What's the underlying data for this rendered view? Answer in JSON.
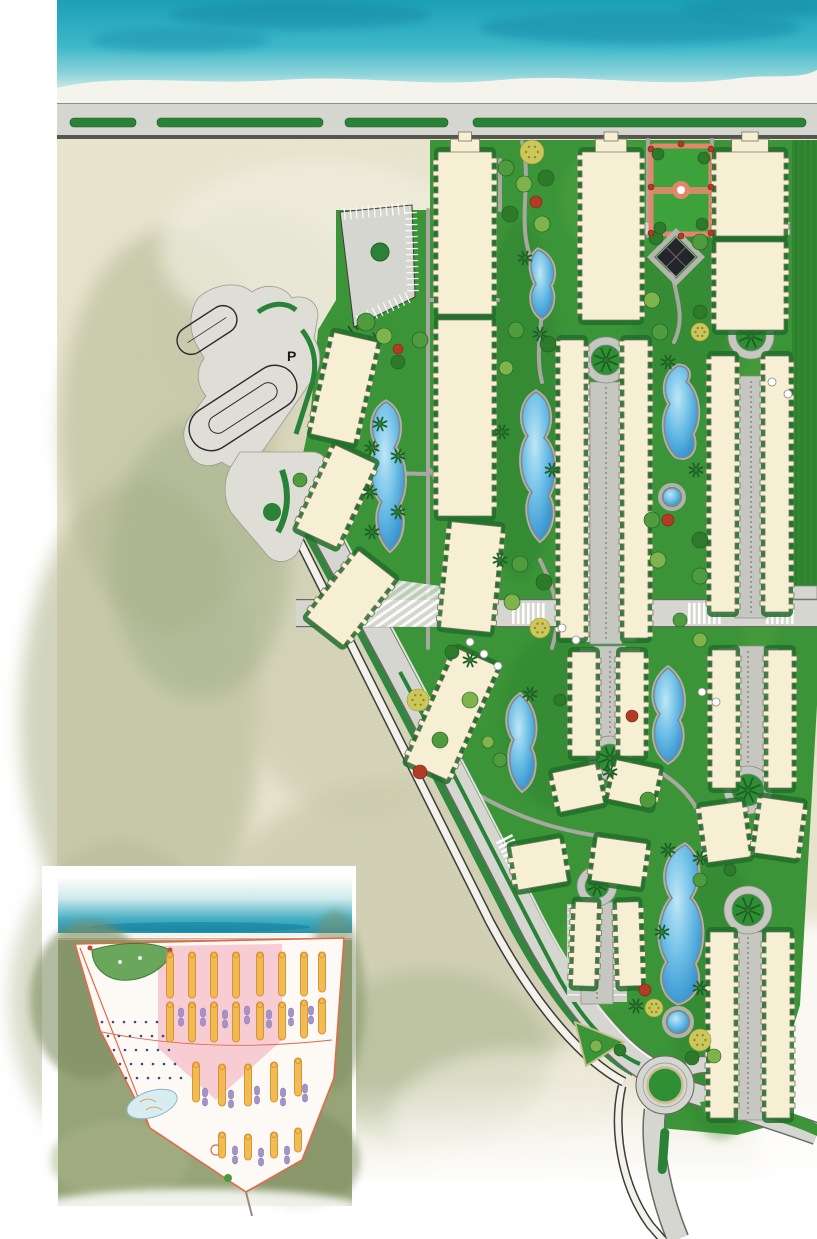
{
  "title": "beachfront-resort-master-plan",
  "labels": {
    "parking_upper": "P",
    "parking_lower": "P"
  },
  "palette": {
    "sea1": "#1d9fb8",
    "sea2": "#3db8c9",
    "sea3": "#8fd4da",
    "foam": "#f5f4ec",
    "road": "#d6d6d0",
    "roadedge": "#55554f",
    "median": "#2a8238",
    "sand1": "#e7e3cd",
    "sand2": "#c9c9ab",
    "sandolive": "#b3b893",
    "site": "#3c9438",
    "sitedark": "#2a7d2e",
    "hedge": "#206f2a",
    "lawnlight": "#52a63e",
    "bld": "#f6efd4",
    "bldedge": "#76765f",
    "path": "#a8a8a0",
    "spine": "#c7c7c1",
    "pool1": "#bfe6f5",
    "pool2": "#2285c8",
    "poolrim": "#7e8a90",
    "treedark": "#2e7a2b",
    "treemid": "#4f9c3e",
    "treelight": "#7fb44c",
    "flower": "#cdc659",
    "red": "#b23b24",
    "palmc": "#1d5f24",
    "pgborder": "#e2876b",
    "pggreen": "#3da23c",
    "diamond": "#24242a",
    "marina": "#dfded6",
    "ink": "#2a2a2a",
    "iland": "#97a478",
    "iline": "#e06a4a",
    "iorange": "#f0b94c",
    "iorangeedge": "#d98f2e",
    "ipurple": "#a493c8",
    "ipink": "#f2a8b4",
    "isea": "#2f9fc0"
  },
  "map": {
    "buildings": [
      {
        "x": 438,
        "y": 152,
        "w": 54,
        "h": 162,
        "cap": 1
      },
      {
        "x": 438,
        "y": 320,
        "w": 54,
        "h": 196
      },
      {
        "x": 582,
        "y": 152,
        "w": 58,
        "h": 168,
        "cap": 1
      },
      {
        "x": 560,
        "y": 340,
        "w": 24,
        "h": 298
      },
      {
        "x": 624,
        "y": 340,
        "w": 24,
        "h": 298
      },
      {
        "x": 716,
        "y": 152,
        "w": 68,
        "h": 84,
        "cap": 1
      },
      {
        "x": 716,
        "y": 242,
        "w": 68,
        "h": 88
      },
      {
        "x": 711,
        "y": 356,
        "w": 24,
        "h": 256
      },
      {
        "x": 765,
        "y": 356,
        "w": 24,
        "h": 256
      },
      {
        "x": 322,
        "y": 336,
        "w": 44,
        "h": 104,
        "r": 13
      },
      {
        "x": 314,
        "y": 450,
        "w": 44,
        "h": 92,
        "r": 25
      },
      {
        "x": 328,
        "y": 556,
        "w": 46,
        "h": 84,
        "r": 38
      },
      {
        "x": 446,
        "y": 524,
        "w": 50,
        "h": 106,
        "r": 6
      },
      {
        "x": 430,
        "y": 652,
        "w": 44,
        "h": 124,
        "r": 24
      },
      {
        "x": 572,
        "y": 652,
        "w": 24,
        "h": 104
      },
      {
        "x": 620,
        "y": 652,
        "w": 24,
        "h": 104
      },
      {
        "x": 556,
        "y": 768,
        "w": 44,
        "h": 40,
        "r": -12
      },
      {
        "x": 612,
        "y": 764,
        "w": 44,
        "h": 40,
        "r": 12
      },
      {
        "x": 712,
        "y": 650,
        "w": 24,
        "h": 138
      },
      {
        "x": 768,
        "y": 650,
        "w": 24,
        "h": 138
      },
      {
        "x": 704,
        "y": 804,
        "w": 42,
        "h": 56,
        "r": -8
      },
      {
        "x": 758,
        "y": 800,
        "w": 42,
        "h": 56,
        "r": 8
      },
      {
        "x": 514,
        "y": 842,
        "w": 50,
        "h": 44,
        "r": -10
      },
      {
        "x": 594,
        "y": 840,
        "w": 50,
        "h": 44,
        "r": 8
      },
      {
        "x": 574,
        "y": 902,
        "w": 22,
        "h": 84,
        "r": 2
      },
      {
        "x": 618,
        "y": 902,
        "w": 22,
        "h": 84,
        "r": -2
      },
      {
        "x": 710,
        "y": 932,
        "w": 24,
        "h": 186
      },
      {
        "x": 766,
        "y": 932,
        "w": 24,
        "h": 186
      }
    ],
    "spines": [
      {
        "x": 606,
        "y1": 384,
        "y2": 642
      },
      {
        "x": 751,
        "y1": 378,
        "y2": 616
      },
      {
        "x": 610,
        "y1": 648,
        "y2": 740
      },
      {
        "x": 748,
        "y1": 648,
        "y2": 768
      },
      {
        "x": 748,
        "y1": 934,
        "y2": 1118
      },
      {
        "x": 597,
        "y1": 904,
        "y2": 1002
      }
    ],
    "culdesacs": [
      {
        "cx": 606,
        "cy": 360,
        "r": 15
      },
      {
        "cx": 751,
        "cy": 336,
        "r": 15
      },
      {
        "cx": 610,
        "cy": 758,
        "r": 14
      },
      {
        "cx": 748,
        "cy": 790,
        "r": 16
      },
      {
        "cx": 748,
        "cy": 910,
        "r": 16
      },
      {
        "cx": 597,
        "cy": 886,
        "r": 12
      }
    ],
    "pools": [
      {
        "d": "M538,250 C528,258 530,272 536,284 C528,296 532,312 542,318 C552,312 556,298 550,286 C558,272 552,256 538,250 Z"
      },
      {
        "d": "M536,392 C522,400 518,420 528,436 C518,452 520,478 532,492 C524,506 528,528 540,540 C552,530 556,510 548,496 C558,478 556,450 544,438 C554,420 550,400 536,392 Z"
      },
      {
        "d": "M536,392 C522,400 518,420 528,436 C518,452 520,478 532,492 C524,506 528,528 540,540 C552,530 556,510 548,496 C558,478 556,450 544,438 C554,420 550,400 536,392 Z",
        "t": "translate(-150,10)"
      },
      {
        "d": "M678,366 C664,374 662,392 670,404 C660,420 664,444 676,456 C690,462 698,448 692,434 C702,418 698,392 686,382 C692,372 686,366 678,366 Z"
      },
      {
        "d": "M520,695 C506,705 504,725 514,740 C506,756 510,778 522,790 C534,782 538,762 530,748 C540,730 534,706 520,695 Z"
      },
      {
        "d": "M668,668 C652,680 650,700 660,714 C650,730 654,752 668,762 C682,754 686,734 678,720 C688,704 684,680 668,668 Z"
      },
      {
        "d": "M685,845 C665,855 660,880 672,898 C658,915 656,945 668,962 C658,975 662,995 678,1003 C696,998 702,980 694,964 C706,945 704,912 690,898 C702,880 700,856 685,845 Z"
      },
      {
        "circle": [
          672,
          497,
          9
        ]
      },
      {
        "circle": [
          678,
          1022,
          11
        ]
      },
      {
        "circle": [
          285,
          325,
          8
        ]
      }
    ],
    "paths": [
      "M428,210 L428,648",
      "M648,140 L648,236",
      "M712,140 L712,236",
      "M522,142 C534,184 512,232 538,272 C550,306 532,344 542,382",
      "M676,240 C660,274 692,306 674,342",
      "M430,470 C452,502 468,556 458,606",
      "M340,472 L428,474",
      "M430,300 L498,300",
      "M470,790 C520,820 560,830 598,836",
      "M660,772 C692,792 712,822 702,858",
      "M540,560 C560,600 560,620 552,648",
      "M500,160 L500,210"
    ],
    "trees": [
      [
        "f",
        532,
        152,
        12
      ],
      [
        "m",
        506,
        168,
        8
      ],
      [
        "l",
        524,
        184,
        8
      ],
      [
        "d",
        546,
        178,
        8
      ],
      [
        "d",
        510,
        214,
        8
      ],
      [
        "l",
        542,
        224,
        8
      ],
      [
        "r",
        536,
        202,
        6
      ],
      [
        "m",
        516,
        330,
        8
      ],
      [
        "d",
        548,
        344,
        8
      ],
      [
        "l",
        506,
        368,
        7
      ],
      [
        "m",
        520,
        564,
        8
      ],
      [
        "d",
        544,
        582,
        8
      ],
      [
        "l",
        512,
        602,
        8
      ],
      [
        "f",
        540,
        628,
        10
      ],
      [
        "d",
        656,
        238,
        7
      ],
      [
        "m",
        700,
        242,
        8
      ],
      [
        "l",
        652,
        300,
        8
      ],
      [
        "d",
        700,
        312,
        7
      ],
      [
        "m",
        660,
        332,
        8
      ],
      [
        "f",
        700,
        332,
        9
      ],
      [
        "r",
        668,
        520,
        6
      ],
      [
        "m",
        652,
        520,
        8
      ],
      [
        "d",
        700,
        540,
        8
      ],
      [
        "l",
        658,
        560,
        8
      ],
      [
        "m",
        700,
        576,
        8
      ],
      [
        "m",
        366,
        322,
        9
      ],
      [
        "l",
        384,
        336,
        8
      ],
      [
        "m",
        420,
        340,
        8
      ],
      [
        "d",
        398,
        362,
        7
      ],
      [
        "r",
        398,
        349,
        5
      ],
      [
        "m",
        300,
        480,
        7
      ],
      [
        "f",
        418,
        700,
        11
      ],
      [
        "r",
        420,
        772,
        7
      ],
      [
        "m",
        440,
        740,
        8
      ],
      [
        "l",
        470,
        700,
        8
      ],
      [
        "d",
        452,
        652,
        7
      ],
      [
        "r",
        632,
        716,
        6
      ],
      [
        "m",
        648,
        800,
        8
      ],
      [
        "f",
        700,
        1040,
        11
      ],
      [
        "l",
        714,
        1056,
        7
      ],
      [
        "d",
        692,
        1058,
        7
      ],
      [
        "r",
        645,
        990,
        6
      ],
      [
        "f",
        654,
        1008,
        9
      ],
      [
        "r",
        651,
        149,
        3
      ],
      [
        "r",
        711,
        149,
        3
      ],
      [
        "r",
        651,
        233,
        3
      ],
      [
        "r",
        711,
        233,
        3
      ],
      [
        "r",
        651,
        187,
        3
      ],
      [
        "r",
        711,
        187,
        3
      ],
      [
        "r",
        681,
        144,
        3
      ],
      [
        "r",
        681,
        236,
        3
      ],
      [
        "d",
        658,
        154,
        6
      ],
      [
        "d",
        704,
        158,
        6
      ],
      [
        "d",
        660,
        228,
        6
      ],
      [
        "d",
        702,
        224,
        6
      ],
      [
        "m",
        500,
        760,
        7
      ],
      [
        "l",
        488,
        742,
        6
      ],
      [
        "d",
        560,
        700,
        6
      ],
      [
        "m",
        680,
        620,
        7
      ],
      [
        "l",
        700,
        640,
        7
      ],
      [
        "d",
        730,
        870,
        6
      ],
      [
        "m",
        700,
        880,
        7
      ],
      [
        "l",
        596,
        1046,
        6
      ],
      [
        "d",
        620,
        1050,
        6
      ]
    ],
    "palms": [
      [
        525,
        258
      ],
      [
        540,
        334
      ],
      [
        502,
        432
      ],
      [
        552,
        470
      ],
      [
        500,
        560
      ],
      [
        668,
        362
      ],
      [
        696,
        470
      ],
      [
        380,
        424
      ],
      [
        372,
        448
      ],
      [
        398,
        456
      ],
      [
        370,
        492
      ],
      [
        398,
        512
      ],
      [
        372,
        532
      ],
      [
        470,
        660
      ],
      [
        530,
        694
      ],
      [
        668,
        850
      ],
      [
        700,
        858
      ],
      [
        662,
        932
      ],
      [
        700,
        988
      ],
      [
        636,
        1006
      ],
      [
        610,
        772
      ]
    ],
    "umbrellas": [
      [
        470,
        642
      ],
      [
        484,
        654
      ],
      [
        498,
        666
      ],
      [
        772,
        382
      ],
      [
        788,
        394
      ],
      [
        562,
        628
      ],
      [
        576,
        640
      ],
      [
        702,
        692
      ],
      [
        716,
        702
      ]
    ],
    "crosswalks": [
      {
        "x": 512,
        "y": 603,
        "n": 7,
        "h": 21,
        "rot": 0
      },
      {
        "x": 688,
        "y": 603,
        "n": 7,
        "h": 21,
        "rot": 0
      },
      {
        "x": 766,
        "y": 603,
        "n": 6,
        "h": 21,
        "rot": 0
      },
      {
        "x": 512,
        "y": 834,
        "n": 8,
        "h": 18,
        "rot": 63
      }
    ],
    "inset": {
      "orange": [
        [
          170,
          952,
          46
        ],
        [
          192,
          952,
          46
        ],
        [
          214,
          952,
          46
        ],
        [
          236,
          952,
          46
        ],
        [
          170,
          1002,
          40
        ],
        [
          192,
          1002,
          40
        ],
        [
          214,
          1002,
          40
        ],
        [
          236,
          1002,
          40
        ],
        [
          260,
          952,
          44
        ],
        [
          282,
          952,
          44
        ],
        [
          304,
          952,
          44
        ],
        [
          322,
          952,
          40
        ],
        [
          260,
          1002,
          38
        ],
        [
          282,
          1002,
          38
        ],
        [
          304,
          1000,
          38
        ],
        [
          322,
          998,
          36
        ],
        [
          196,
          1062,
          40
        ],
        [
          222,
          1064,
          42
        ],
        [
          248,
          1064,
          42
        ],
        [
          274,
          1062,
          40
        ],
        [
          298,
          1058,
          38
        ],
        [
          222,
          1132,
          26
        ],
        [
          248,
          1134,
          26
        ],
        [
          274,
          1132,
          26
        ],
        [
          298,
          1128,
          24
        ]
      ],
      "purple": [
        [
          181,
          1008
        ],
        [
          203,
          1008
        ],
        [
          225,
          1010
        ],
        [
          247,
          1006
        ],
        [
          269,
          1010
        ],
        [
          291,
          1008
        ],
        [
          311,
          1006
        ],
        [
          205,
          1088
        ],
        [
          231,
          1090
        ],
        [
          257,
          1086
        ],
        [
          283,
          1088
        ],
        [
          305,
          1084
        ],
        [
          235,
          1146
        ],
        [
          261,
          1148
        ],
        [
          287,
          1146
        ]
      ],
      "villas": {
        "x0": 102,
        "y0": 1022,
        "rows": 5,
        "cols": 6,
        "dx": 11,
        "dy": 14,
        "skew": 6
      }
    }
  }
}
